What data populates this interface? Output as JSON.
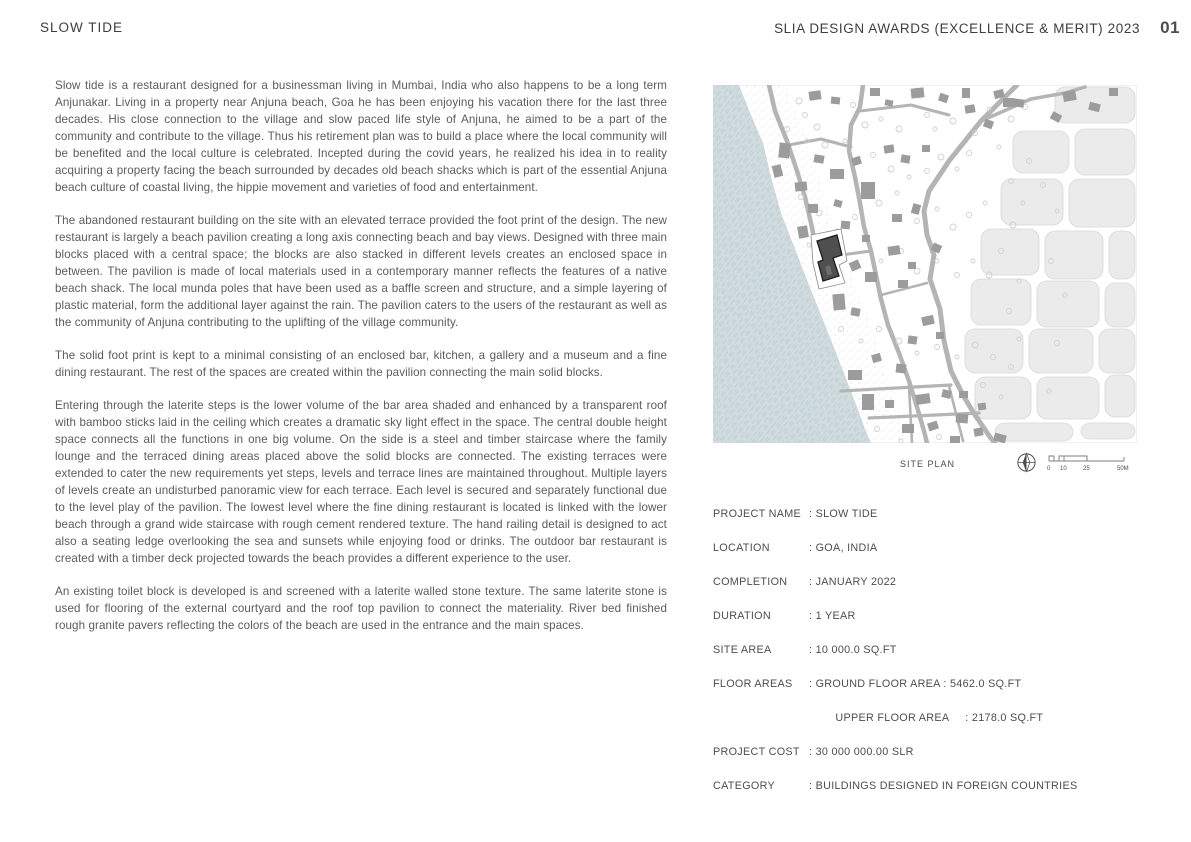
{
  "page": {
    "title": "SLOW TIDE",
    "header_right": "SLIA DESIGN AWARDS (EXCELLENCE & MERIT) 2023",
    "page_number": "01"
  },
  "body": {
    "paragraphs": [
      "Slow tide is a restaurant designed for a businessman living in Mumbai, India who also happens to be a long term Anjunakar. Living in a property near Anjuna beach, Goa he has been enjoying his vacation there for the last three decades. His close connection to the village and slow paced life style of Anjuna, he aimed to be a part of the community and contribute to the village. Thus his retirement plan was to build a place where the local community will be benefited and the local culture is celebrated. Incepted during the covid years, he realized his idea in to reality acquiring a property facing the beach surrounded by decades old beach shacks which is part of the essential Anjuna beach culture of coastal living, the hippie movement and varieties of food and entertainment.",
      "The abandoned restaurant building on the site with an elevated terrace provided the foot print of the design. The new restaurant is largely a beach pavilion creating a long axis connecting beach and bay views. Designed with three main blocks placed with a central space; the blocks are also stacked in different levels creates an enclosed space in between. The pavilion is made of local materials used in a contemporary manner reflects the features of a native beach shack. The local munda poles that have been used as a baffle screen and structure, and a simple layering of plastic material, form the additional layer against the rain. The pavilion caters to the users of the restaurant as well as the community of Anjuna contributing to the uplifting of the village community.",
      "The solid foot print is kept to a minimal consisting of an enclosed bar, kitchen, a gallery and a museum and a fine dining restaurant. The rest of the spaces are created within the pavilion connecting the main solid blocks.",
      "Entering through the laterite steps is the lower volume of the bar area shaded and enhanced by a transparent roof with bamboo sticks laid in the ceiling which creates a dramatic sky light effect in the space. The central double height space connects all the functions in one big volume. On the side is a steel and timber staircase where the family lounge and the terraced dining areas placed above the solid blocks are connected. The existing terraces were extended to cater the new requirements yet steps, levels and terrace lines are maintained throughout. Multiple layers of levels create an undisturbed panoramic view for each terrace. Each level is secured and separately functional due to the level play of the pavilion. The lowest level where the fine dining restaurant is located is linked with the lower beach through a grand wide staircase with rough cement rendered texture. The hand railing detail is designed to act also a seating ledge overlooking the sea and sunsets while enjoying food or drinks. The outdoor bar restaurant is created with a timber deck projected towards the beach provides a different experience to the user.",
      "An existing toilet block is developed is and screened with a laterite walled stone texture. The same laterite stone is used for flooring of the external courtyard and the roof top pavilion to connect the materiality. River bed finished rough granite pavers reflecting the colors of the beach are used in the entrance and the main spaces."
    ]
  },
  "site_plan": {
    "caption": "SITE PLAN",
    "north_icon": "north-arrow",
    "scale_labels": [
      "0",
      "10",
      "25",
      "50M"
    ]
  },
  "details": {
    "rows": [
      {
        "label": "PROJECT NAME",
        "value": ": SLOW TIDE"
      },
      {
        "label": "LOCATION",
        "value": ": GOA, INDIA"
      },
      {
        "label": "COMPLETION",
        "value": ": JANUARY 2022"
      },
      {
        "label": "DURATION",
        "value": ": 1 YEAR"
      },
      {
        "label": "SITE AREA",
        "value": ": 10 000.0 SQ.FT"
      },
      {
        "label": "FLOOR AREAS",
        "value": ": GROUND FLOOR AREA : 5462.0 SQ.FT",
        "value2": "  UPPER FLOOR AREA     : 2178.0 SQ.FT"
      },
      {
        "label": "PROJECT COST",
        "value": ": 30 000 000.00 SLR"
      },
      {
        "label": "CATEGORY",
        "value": ": BUILDINGS DESIGNED IN FOREIGN COUNTRIES"
      }
    ]
  },
  "colors": {
    "heading_text": "#3d3e40",
    "body_text": "#5a5b5d",
    "sea": "#cfdbde",
    "sea_hatch": "#b2c2c8",
    "sand_dot": "#dcdcdc",
    "road": "#b4b4b4",
    "building": "#9c9c9c",
    "site_building": "#4f4f4f",
    "field": "#ebebeb",
    "tree_stroke": "#cdd1d1"
  }
}
